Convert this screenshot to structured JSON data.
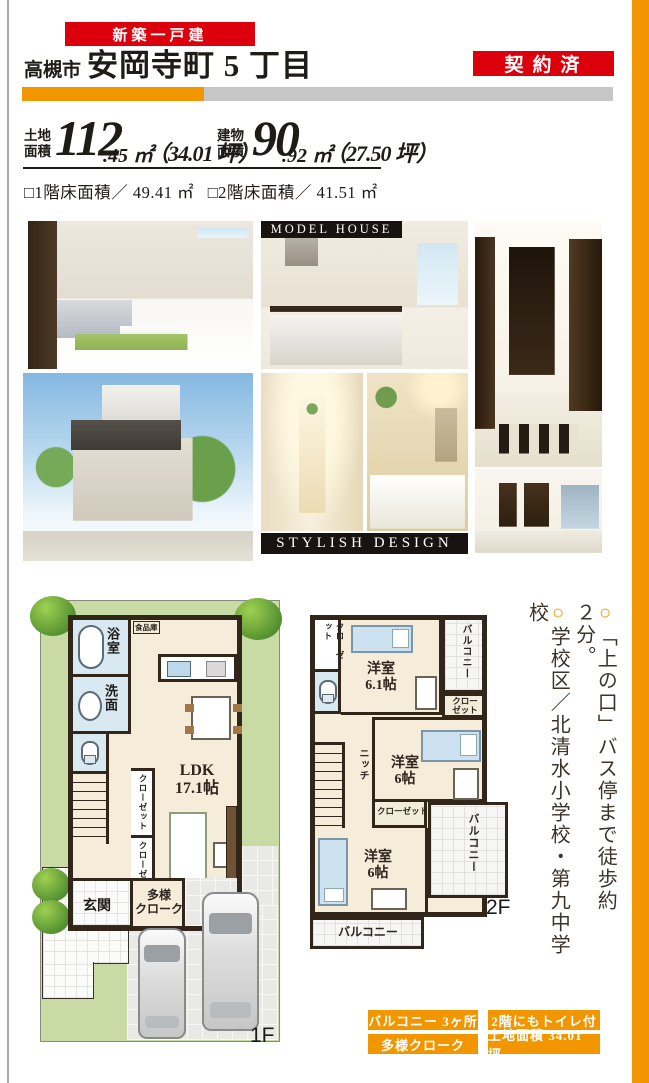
{
  "colors": {
    "accent_red": "#dc000c",
    "accent_orange": "#f29600",
    "bar_gray": "#c6c6c6",
    "banner_black": "#181310"
  },
  "header": {
    "category_badge": "新築一戸建",
    "city": "高槻市",
    "title": "安岡寺町 5 丁目",
    "status_badge": "契約済"
  },
  "area": {
    "land_l1": "土地",
    "land_l2": "面積",
    "land_int": "112",
    "land_dec": ".45 ㎡",
    "land_tsubo": "（34.01 坪）",
    "bldg_l1": "建物",
    "bldg_l2": "面積",
    "bldg_int": "90",
    "bldg_dec": ".92 ㎡",
    "bldg_tsubo": "（27.50 坪）",
    "floor1": "□1階床面積／ 49.41 ㎡",
    "floor2": "□2階床面積／ 41.51 ㎡"
  },
  "photos": {
    "model_house_banner": "MODEL HOUSE",
    "stylish_design_banner": "STYLISH DESIGN",
    "names": [
      "living-room",
      "kitchen",
      "entrance-hall",
      "exterior",
      "niche",
      "bathroom",
      "bedroom"
    ]
  },
  "plan_1f": {
    "label": "1F",
    "bath": "浴室",
    "washroom": "洗面",
    "pantry": "食品庫",
    "ldk_name": "LDK",
    "ldk_size": "17.1帖",
    "closet_a": "クローゼット",
    "closet_b": "クローゼット",
    "entrance": "玄関",
    "cloak_l1": "多様",
    "cloak_l2": "クローク"
  },
  "plan_2f": {
    "label": "2F",
    "closet_tl": "クローゼット",
    "room1_name": "洋室",
    "room1_size": "6.1帖",
    "balcony_top": "バルコニー",
    "closet_r_l1": "クロー",
    "closet_r_l2": "ゼット",
    "niche": "ニッチ",
    "room2_name": "洋室",
    "room2_size": "6帖",
    "closet_mid": "クローゼット",
    "balcony_right": "バルコニー",
    "room3_name": "洋室",
    "room3_size": "6帖",
    "balcony_bottom": "バルコニー"
  },
  "notes": {
    "marker1": "○",
    "note1": "「上の口」バス停まで徒歩約２分。",
    "marker2": "○",
    "note2": "学校区／北清水小学校・第九中学校"
  },
  "footer": {
    "badges": [
      "バルコニー 3ヶ所",
      "2階にもトイレ付",
      "多様クローク",
      "土地面積 34.01 坪"
    ]
  }
}
